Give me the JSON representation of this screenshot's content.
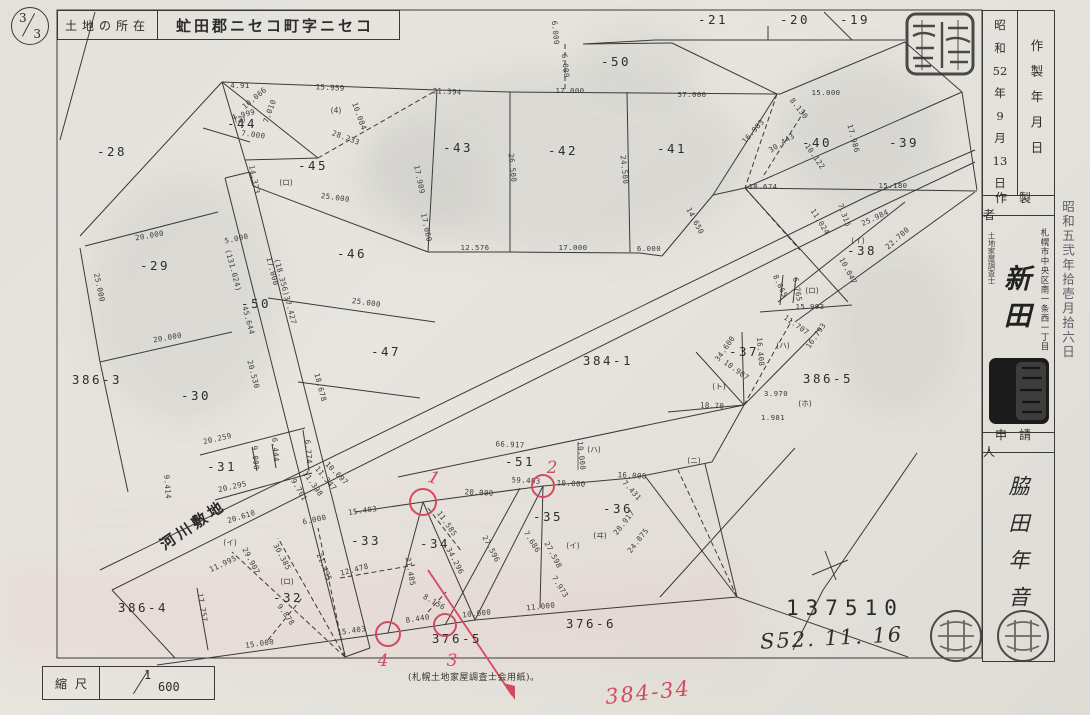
{
  "page": {
    "numerator": "3",
    "denominator": "3"
  },
  "header": {
    "location_label": "土地の所在",
    "location_value": "虻田郡ニセコ町字ニセコ"
  },
  "side_panel": {
    "created_label": "作製年月日",
    "created_date_parts": [
      "昭",
      "和",
      "52",
      "年",
      "9",
      "月",
      "13",
      "日"
    ],
    "maker_label": "作製者",
    "maker_title": "土地家屋調査士",
    "maker_address": "札幌市中央区南一条西一丁目",
    "maker_name": "新田",
    "applicant_label": "申請人",
    "applicant_name": "脇田年音",
    "date_stamp": "昭和五弐年拾壱月拾六日"
  },
  "footer": {
    "scale_label": "縮尺",
    "scale_numerator": "1",
    "scale_denominator": "600",
    "paper_note": "(札幌土地家屋調査士会用紙)。",
    "document_number": "137510",
    "handwritten_date": "S52. 11. 16",
    "red_annotation": "384-34"
  },
  "colors": {
    "red": "#d5495e",
    "ink": "#3a3a3a"
  },
  "map": {
    "labels": [
      {
        "t": "-28",
        "x": 112,
        "y": 156,
        "c": "p"
      },
      {
        "t": "-29",
        "x": 155,
        "y": 270,
        "c": "p"
      },
      {
        "t": "-30",
        "x": 196,
        "y": 400,
        "c": "p"
      },
      {
        "t": "386-3",
        "x": 97,
        "y": 384,
        "c": "p"
      },
      {
        "t": "-44",
        "x": 242,
        "y": 128,
        "c": "p"
      },
      {
        "t": "-45",
        "x": 313,
        "y": 170,
        "c": "p"
      },
      {
        "t": "-46",
        "x": 352,
        "y": 258,
        "c": "p"
      },
      {
        "t": "-47",
        "x": 386,
        "y": 356,
        "c": "p"
      },
      {
        "t": "-50",
        "x": 256,
        "y": 308,
        "c": "p"
      },
      {
        "t": "-50",
        "x": 616,
        "y": 66,
        "c": "p"
      },
      {
        "t": "-43",
        "x": 458,
        "y": 152,
        "c": "p"
      },
      {
        "t": "-42",
        "x": 563,
        "y": 155,
        "c": "p"
      },
      {
        "t": "-41",
        "x": 672,
        "y": 153,
        "c": "p"
      },
      {
        "t": "-40",
        "x": 817,
        "y": 147,
        "c": "p"
      },
      {
        "t": "-39",
        "x": 904,
        "y": 147,
        "c": "p"
      },
      {
        "t": "-38",
        "x": 862,
        "y": 255,
        "c": "p"
      },
      {
        "t": "-37",
        "x": 744,
        "y": 356,
        "c": "p"
      },
      {
        "t": "386-5",
        "x": 828,
        "y": 383,
        "c": "p"
      },
      {
        "t": "384-1",
        "x": 608,
        "y": 365,
        "c": "p"
      },
      {
        "t": "-51",
        "x": 520,
        "y": 466,
        "c": "p"
      },
      {
        "t": "-35",
        "x": 548,
        "y": 521,
        "c": "p"
      },
      {
        "t": "-36",
        "x": 618,
        "y": 513,
        "c": "p"
      },
      {
        "t": "-33",
        "x": 366,
        "y": 545,
        "c": "p"
      },
      {
        "t": "-34",
        "x": 435,
        "y": 548,
        "c": "p"
      },
      {
        "t": "-31",
        "x": 222,
        "y": 471,
        "c": "p"
      },
      {
        "t": "-32",
        "x": 288,
        "y": 602,
        "c": "p"
      },
      {
        "t": "386-4",
        "x": 143,
        "y": 612,
        "c": "p"
      },
      {
        "t": "376-5",
        "x": 457,
        "y": 643,
        "c": "p"
      },
      {
        "t": "376-6",
        "x": 591,
        "y": 628,
        "c": "p"
      },
      {
        "t": "-21",
        "x": 713,
        "y": 24,
        "c": "p"
      },
      {
        "t": "-20",
        "x": 795,
        "y": 24,
        "c": "p"
      },
      {
        "t": "-19",
        "x": 855,
        "y": 24,
        "c": "p"
      },
      {
        "t": "河川敷地",
        "x": 196,
        "y": 529,
        "r": -34,
        "c": "river"
      },
      {
        "t": "20.000",
        "x": 150,
        "y": 238,
        "r": -10
      },
      {
        "t": "25.000",
        "x": 97,
        "y": 288,
        "r": 78
      },
      {
        "t": "20.000",
        "x": 168,
        "y": 340,
        "r": -10
      },
      {
        "t": "4.91",
        "x": 240,
        "y": 88
      },
      {
        "t": "10.066",
        "x": 256,
        "y": 100,
        "r": -40
      },
      {
        "t": "7.010",
        "x": 272,
        "y": 112,
        "r": -70
      },
      {
        "t": "4.999",
        "x": 244,
        "y": 117,
        "r": -15
      },
      {
        "t": "7.000",
        "x": 253,
        "y": 137,
        "r": 8
      },
      {
        "t": "14.323",
        "x": 252,
        "y": 180,
        "r": 78
      },
      {
        "t": "15.959",
        "x": 330,
        "y": 90,
        "r": 3
      },
      {
        "t": "28.233",
        "x": 345,
        "y": 140,
        "r": 20
      },
      {
        "t": "10.084",
        "x": 357,
        "y": 117,
        "r": 70
      },
      {
        "t": "21.394",
        "x": 447,
        "y": 94,
        "r": 3
      },
      {
        "t": "17.909",
        "x": 417,
        "y": 180,
        "r": 78
      },
      {
        "t": "17.060",
        "x": 424,
        "y": 228,
        "r": 78
      },
      {
        "t": "12.576",
        "x": 475,
        "y": 250
      },
      {
        "t": "25.000",
        "x": 335,
        "y": 200,
        "r": 8
      },
      {
        "t": "25.000",
        "x": 366,
        "y": 305,
        "r": 8
      },
      {
        "t": "17.000",
        "x": 570,
        "y": 93
      },
      {
        "t": "17.000",
        "x": 573,
        "y": 250
      },
      {
        "t": "57.000",
        "x": 692,
        "y": 97
      },
      {
        "t": "6.000",
        "x": 649,
        "y": 251
      },
      {
        "t": "26.500",
        "x": 510,
        "y": 168,
        "r": 84
      },
      {
        "t": "24.500",
        "x": 622,
        "y": 170,
        "r": 84
      },
      {
        "t": "6.000",
        "x": 553,
        "y": 33,
        "r": 84
      },
      {
        "t": "6.000",
        "x": 563,
        "y": 66,
        "r": 84
      },
      {
        "t": "14.650",
        "x": 693,
        "y": 222,
        "r": 62
      },
      {
        "t": "15.000",
        "x": 826,
        "y": 95
      },
      {
        "t": "8.130",
        "x": 797,
        "y": 110,
        "r": 52
      },
      {
        "t": "30.443",
        "x": 783,
        "y": 145,
        "r": -33
      },
      {
        "t": "10.122",
        "x": 813,
        "y": 158,
        "r": 55
      },
      {
        "t": "16.903",
        "x": 755,
        "y": 133,
        "r": -48
      },
      {
        "t": "17.986",
        "x": 851,
        "y": 139,
        "r": 75
      },
      {
        "t": "18.674",
        "x": 763,
        "y": 189
      },
      {
        "t": "15.180",
        "x": 893,
        "y": 188
      },
      {
        "t": "25.984",
        "x": 876,
        "y": 220,
        "r": -25
      },
      {
        "t": "22.700",
        "x": 899,
        "y": 240,
        "r": -42
      },
      {
        "t": "11.024",
        "x": 818,
        "y": 223,
        "r": 58
      },
      {
        "t": "7.315",
        "x": 842,
        "y": 216,
        "r": 70
      },
      {
        "t": "10.047",
        "x": 846,
        "y": 272,
        "r": 62
      },
      {
        "t": "15.993",
        "x": 810,
        "y": 309
      },
      {
        "t": "6.765",
        "x": 795,
        "y": 290,
        "r": 80
      },
      {
        "t": "8.865",
        "x": 778,
        "y": 287,
        "r": 65
      },
      {
        "t": "(131.024)",
        "x": 231,
        "y": 271,
        "r": 75
      },
      {
        "t": "45.644",
        "x": 246,
        "y": 321,
        "r": 75
      },
      {
        "t": "5.000",
        "x": 237,
        "y": 241,
        "r": -12
      },
      {
        "t": "17.000",
        "x": 270,
        "y": 272,
        "r": 75
      },
      {
        "t": "(18.356)37.427",
        "x": 283,
        "y": 292,
        "r": 75
      },
      {
        "t": "20.530",
        "x": 251,
        "y": 375,
        "r": 75
      },
      {
        "t": "18.678",
        "x": 318,
        "y": 388,
        "r": 75
      },
      {
        "t": "20.259",
        "x": 218,
        "y": 441,
        "r": -13
      },
      {
        "t": "20.295",
        "x": 233,
        "y": 489,
        "r": -13
      },
      {
        "t": "9.000",
        "x": 253,
        "y": 458,
        "r": 85
      },
      {
        "t": "6.444",
        "x": 273,
        "y": 450,
        "r": 85
      },
      {
        "t": "6.774",
        "x": 306,
        "y": 452,
        "r": 85
      },
      {
        "t": "9.414",
        "x": 165,
        "y": 487,
        "r": 85
      },
      {
        "t": "20.610",
        "x": 242,
        "y": 519,
        "r": -17
      },
      {
        "t": "11.995",
        "x": 224,
        "y": 566,
        "r": -25
      },
      {
        "t": "29.907",
        "x": 249,
        "y": 562,
        "r": 62
      },
      {
        "t": "30.385",
        "x": 280,
        "y": 558,
        "r": 62
      },
      {
        "t": "21.495",
        "x": 322,
        "y": 568,
        "r": 68
      },
      {
        "t": "12.478",
        "x": 355,
        "y": 572,
        "r": -15
      },
      {
        "t": "17.757",
        "x": 200,
        "y": 608,
        "r": 80
      },
      {
        "t": "15.000",
        "x": 260,
        "y": 646,
        "r": -8
      },
      {
        "t": "9.878",
        "x": 284,
        "y": 616,
        "r": 55
      },
      {
        "t": "15.403",
        "x": 352,
        "y": 633,
        "r": -8
      },
      {
        "t": "8.440",
        "x": 418,
        "y": 621,
        "r": -8
      },
      {
        "t": "8.156",
        "x": 433,
        "y": 604,
        "r": 30
      },
      {
        "t": "10.000",
        "x": 477,
        "y": 616,
        "r": -6
      },
      {
        "t": "11.000",
        "x": 541,
        "y": 609,
        "r": -6
      },
      {
        "t": "21.485",
        "x": 408,
        "y": 572,
        "r": 80
      },
      {
        "t": "15.403",
        "x": 363,
        "y": 513,
        "r": -8
      },
      {
        "t": "11.585",
        "x": 445,
        "y": 525,
        "r": 55
      },
      {
        "t": "34.296",
        "x": 453,
        "y": 562,
        "r": 62
      },
      {
        "t": "27.596",
        "x": 489,
        "y": 550,
        "r": 62
      },
      {
        "t": "7.686",
        "x": 530,
        "y": 543,
        "r": 58
      },
      {
        "t": "27.598",
        "x": 551,
        "y": 556,
        "r": 62
      },
      {
        "t": "7.973",
        "x": 558,
        "y": 588,
        "r": 58
      },
      {
        "t": "66.917",
        "x": 510,
        "y": 447,
        "r": 3
      },
      {
        "t": "59.403",
        "x": 526,
        "y": 483,
        "r": 3
      },
      {
        "t": "10.000",
        "x": 571,
        "y": 486,
        "r": 3
      },
      {
        "t": "20.000",
        "x": 479,
        "y": 495,
        "r": 3
      },
      {
        "t": "10.000",
        "x": 579,
        "y": 456,
        "r": 84
      },
      {
        "t": "16.000",
        "x": 632,
        "y": 478,
        "r": 3
      },
      {
        "t": "7.431",
        "x": 630,
        "y": 492,
        "r": 48
      },
      {
        "t": "28.917",
        "x": 626,
        "y": 524,
        "r": -52
      },
      {
        "t": "24.875",
        "x": 640,
        "y": 542,
        "r": -52
      },
      {
        "t": "10.907",
        "x": 735,
        "y": 372,
        "r": 36
      },
      {
        "t": "18.70",
        "x": 712,
        "y": 408,
        "r": 3
      },
      {
        "t": "16.408",
        "x": 758,
        "y": 352,
        "r": 85
      },
      {
        "t": "11.707",
        "x": 795,
        "y": 327,
        "r": 35
      },
      {
        "t": "16.793",
        "x": 818,
        "y": 337,
        "r": -55
      },
      {
        "t": "34.600",
        "x": 727,
        "y": 350,
        "r": -55
      },
      {
        "t": "3.970",
        "x": 776,
        "y": 396
      },
      {
        "t": "1.981",
        "x": 773,
        "y": 420
      },
      {
        "t": "9.701",
        "x": 297,
        "y": 491,
        "r": 60
      },
      {
        "t": "11.398",
        "x": 311,
        "y": 485,
        "r": 55
      },
      {
        "t": "11.347",
        "x": 324,
        "y": 480,
        "r": 50
      },
      {
        "t": "10.697",
        "x": 335,
        "y": 475,
        "r": 45
      },
      {
        "t": "6.000",
        "x": 315,
        "y": 522,
        "r": -12
      },
      {
        "t": "(4)",
        "x": 336,
        "y": 113,
        "c": "cat"
      },
      {
        "t": "(2)",
        "x": 240,
        "y": 122,
        "c": "cat"
      },
      {
        "t": "(ロ)",
        "x": 286,
        "y": 185,
        "c": "cat"
      },
      {
        "t": "(イ)",
        "x": 858,
        "y": 243,
        "c": "cat"
      },
      {
        "t": "(ロ)",
        "x": 812,
        "y": 293,
        "c": "cat"
      },
      {
        "t": "(ハ)",
        "x": 783,
        "y": 348,
        "c": "cat"
      },
      {
        "t": "(ホ)",
        "x": 805,
        "y": 406,
        "c": "cat"
      },
      {
        "t": "(ト)",
        "x": 719,
        "y": 389,
        "c": "cat"
      },
      {
        "t": "(ニ)",
        "x": 694,
        "y": 463,
        "c": "cat"
      },
      {
        "t": "(ハ)",
        "x": 594,
        "y": 452,
        "c": "cat"
      },
      {
        "t": "(イ)",
        "x": 573,
        "y": 548,
        "c": "cat"
      },
      {
        "t": "(ヰ)",
        "x": 600,
        "y": 538,
        "c": "cat"
      },
      {
        "t": "(イ)",
        "x": 230,
        "y": 545,
        "c": "cat"
      },
      {
        "t": "(ロ)",
        "x": 287,
        "y": 584,
        "c": "cat"
      }
    ],
    "red_circles": [
      {
        "x": 423,
        "y": 502,
        "r": 13,
        "label": "1",
        "lx": 432,
        "ly": 483,
        "lr": 20
      },
      {
        "x": 543,
        "y": 486,
        "r": 11,
        "label": "2",
        "lx": 552,
        "ly": 473,
        "lr": 0
      },
      {
        "x": 445,
        "y": 625,
        "r": 11,
        "label": "3",
        "lx": 452,
        "ly": 666,
        "lr": 0
      },
      {
        "x": 388,
        "y": 634,
        "r": 12,
        "label": "4",
        "lx": 383,
        "ly": 666,
        "lr": 0
      }
    ]
  }
}
